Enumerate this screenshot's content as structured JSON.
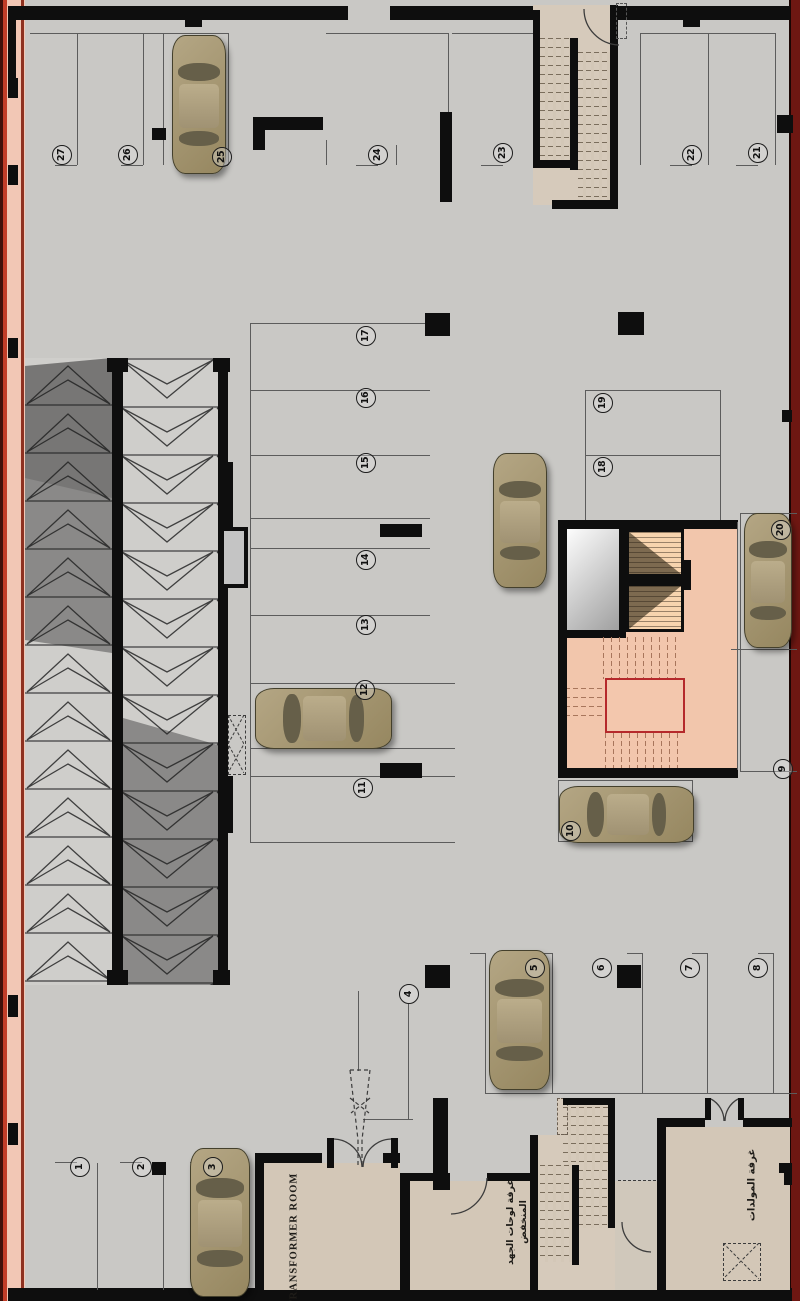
{
  "rooms": {
    "transformer": {
      "label": "TRANSFORMER ROOM"
    },
    "low_voltage": {
      "label_line1": "غرفة لوحات الجهد",
      "label_line2": "المنخفض"
    },
    "generator": {
      "label": "غرفة المولدات"
    }
  },
  "colors": {
    "floor": "#c9c8c5",
    "wall": "#0e0e0e",
    "left_border": "#f2c7b5",
    "right_border": "#6e1712",
    "stair_accent_red": "#b5292b",
    "lobby_salmon": "#f2c6ac",
    "room_tan": "#d3c7b7",
    "car_body": "#a59676"
  },
  "spots": [
    {
      "n": "1",
      "x": 80,
      "y": 1167
    },
    {
      "n": "2",
      "x": 142,
      "y": 1167
    },
    {
      "n": "3",
      "x": 213,
      "y": 1167
    },
    {
      "n": "4",
      "x": 409,
      "y": 994
    },
    {
      "n": "5",
      "x": 535,
      "y": 968
    },
    {
      "n": "6",
      "x": 602,
      "y": 968
    },
    {
      "n": "7",
      "x": 690,
      "y": 968
    },
    {
      "n": "8",
      "x": 758,
      "y": 968
    },
    {
      "n": "9",
      "x": 783,
      "y": 769
    },
    {
      "n": "10",
      "x": 571,
      "y": 831
    },
    {
      "n": "11",
      "x": 363,
      "y": 788
    },
    {
      "n": "12",
      "x": 365,
      "y": 690
    },
    {
      "n": "13",
      "x": 366,
      "y": 625
    },
    {
      "n": "14",
      "x": 366,
      "y": 560
    },
    {
      "n": "15",
      "x": 366,
      "y": 463
    },
    {
      "n": "16",
      "x": 366,
      "y": 398
    },
    {
      "n": "17",
      "x": 366,
      "y": 336
    },
    {
      "n": "18",
      "x": 603,
      "y": 467
    },
    {
      "n": "19",
      "x": 603,
      "y": 403
    },
    {
      "n": "20",
      "x": 781,
      "y": 530
    },
    {
      "n": "21",
      "x": 758,
      "y": 153
    },
    {
      "n": "22",
      "x": 692,
      "y": 155
    },
    {
      "n": "23",
      "x": 503,
      "y": 153
    },
    {
      "n": "24",
      "x": 378,
      "y": 155
    },
    {
      "n": "25",
      "x": 222,
      "y": 157
    },
    {
      "n": "26",
      "x": 128,
      "y": 155
    },
    {
      "n": "27",
      "x": 62,
      "y": 155
    }
  ],
  "cars": [
    {
      "x": 172,
      "y": 35,
      "w": 52,
      "h": 137,
      "o": "v"
    },
    {
      "x": 255,
      "y": 688,
      "w": 135,
      "h": 59,
      "o": "h"
    },
    {
      "x": 493,
      "y": 453,
      "w": 52,
      "h": 133,
      "o": "v"
    },
    {
      "x": 744,
      "y": 513,
      "w": 46,
      "h": 133,
      "o": "v"
    },
    {
      "x": 559,
      "y": 786,
      "w": 133,
      "h": 55,
      "o": "h"
    },
    {
      "x": 489,
      "y": 950,
      "w": 59,
      "h": 138,
      "o": "v"
    },
    {
      "x": 190,
      "y": 1148,
      "w": 58,
      "h": 147,
      "o": "v"
    }
  ]
}
